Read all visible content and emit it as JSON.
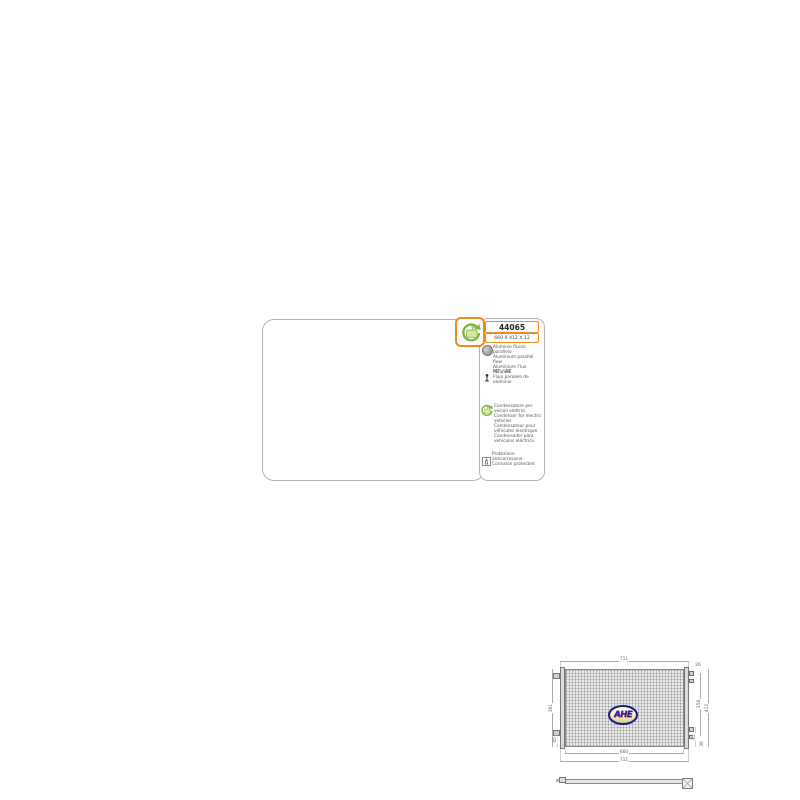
{
  "info_panel": {
    "part_number": "44065",
    "size": "660 X 412 X 12",
    "material_lines": [
      "Aluminio flusso parallelo",
      "Aluminium parallel flow",
      "Aluminium Flux Parallèle",
      "Flujo paralelo de aluminio"
    ],
    "transmission": "MT / AT",
    "electric_lines": [
      "Condensatore per",
      "veicoli elettrici",
      "Condenser for electric",
      "vehicles",
      "Condensateur pour",
      "véhicules électrique",
      "Condensador para",
      "vehículos eléctrico"
    ],
    "corrosion_lines": [
      "Protezione anticorrosione",
      "Corrosion protected"
    ]
  },
  "drawing": {
    "brand": "AHE",
    "dim_top_width": "711",
    "dim_core_width": "660",
    "dim_overall_width": "711",
    "dim_left_height": "361",
    "dim_left_offset": "45",
    "dim_right_inner": "358",
    "dim_right_outer": "412",
    "dim_right_offset_a": "85",
    "dim_right_offset_b": "36",
    "dim_port": "26"
  },
  "colors": {
    "accent_orange": "#ee8b1e",
    "accent_green": "#79b636",
    "panel_border": "#b4b4b4",
    "logo_blue": "#2424b4"
  }
}
